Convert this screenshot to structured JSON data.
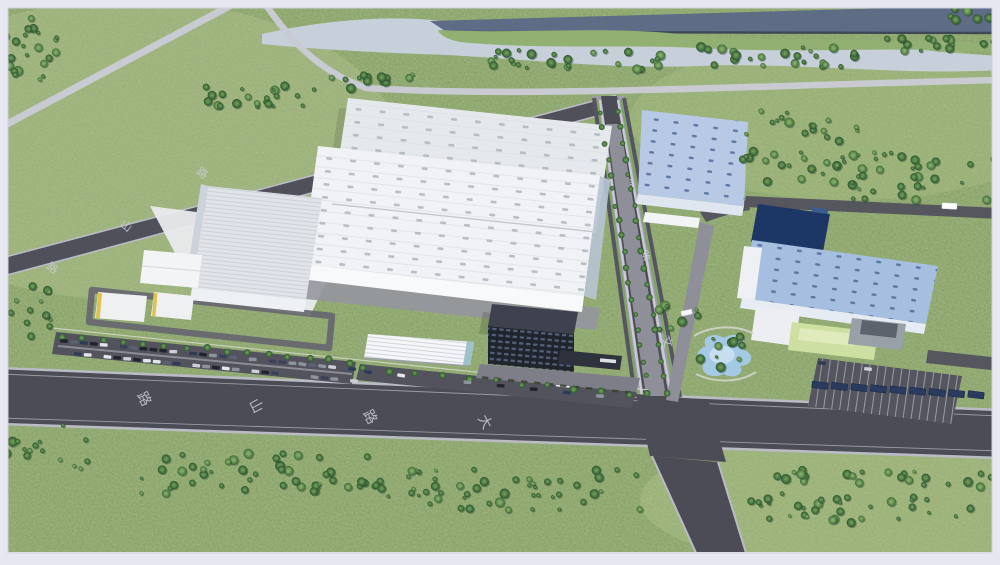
{
  "scene": {
    "type": "aerial-architectural-rendering",
    "description": "Bird's-eye 3D rendering of an industrial factory campus: large white ribbed production halls with a dark office block on the left, a second campus with blue glass-roofed halls, a navy logo building, green-roofed offices, a landscaped pond and parking on the right, surrounded by grassland, tree rows, a canal and roads painted with Chinese road-name characters."
  },
  "road_markings": {
    "main_road": [
      {
        "char": "路",
        "x": 140,
        "y": 401,
        "rot": 62,
        "size": 14
      },
      {
        "char": "山",
        "x": 252,
        "y": 408,
        "rot": 62,
        "size": 14
      },
      {
        "char": "路",
        "x": 366,
        "y": 419,
        "rot": 62,
        "size": 14
      },
      {
        "char": "大",
        "x": 481,
        "y": 424,
        "rot": 62,
        "size": 14
      }
    ],
    "middle_road": [
      {
        "char": "路",
        "x": 624,
        "y": 186,
        "rot": 72,
        "size": 11
      },
      {
        "char": "路",
        "x": 641,
        "y": 257,
        "rot": 72,
        "size": 11
      },
      {
        "char": "文",
        "x": 663,
        "y": 343,
        "rot": 72,
        "size": 12
      }
    ],
    "back_road": [
      {
        "char": "路",
        "x": 50,
        "y": 271,
        "rot": 38,
        "size": 11
      },
      {
        "char": "山",
        "x": 124,
        "y": 229,
        "rot": 38,
        "size": 11
      },
      {
        "char": "路",
        "x": 200,
        "y": 176,
        "rot": 38,
        "size": 11
      }
    ]
  },
  "palette": {
    "frame": "#e6e7f1",
    "grass": "#a3b87f",
    "grass_light": "#b5c490",
    "tree_dark": "#2f5a38",
    "road_dark": "#4c4c57",
    "road_light": "#c9cbd3",
    "curb": "#b9bbc5",
    "canal_water": "#5e6c86",
    "wetland_water": "#c6cfda",
    "roof_white": "#eff1f4",
    "roof_blue": "#a6bedf",
    "navy_building": "#1c3766",
    "office_tower": "#23272f",
    "green_roof": "#cde0a2",
    "pond": "#a3c9e4",
    "marking_paint": "#c9ccd6"
  }
}
